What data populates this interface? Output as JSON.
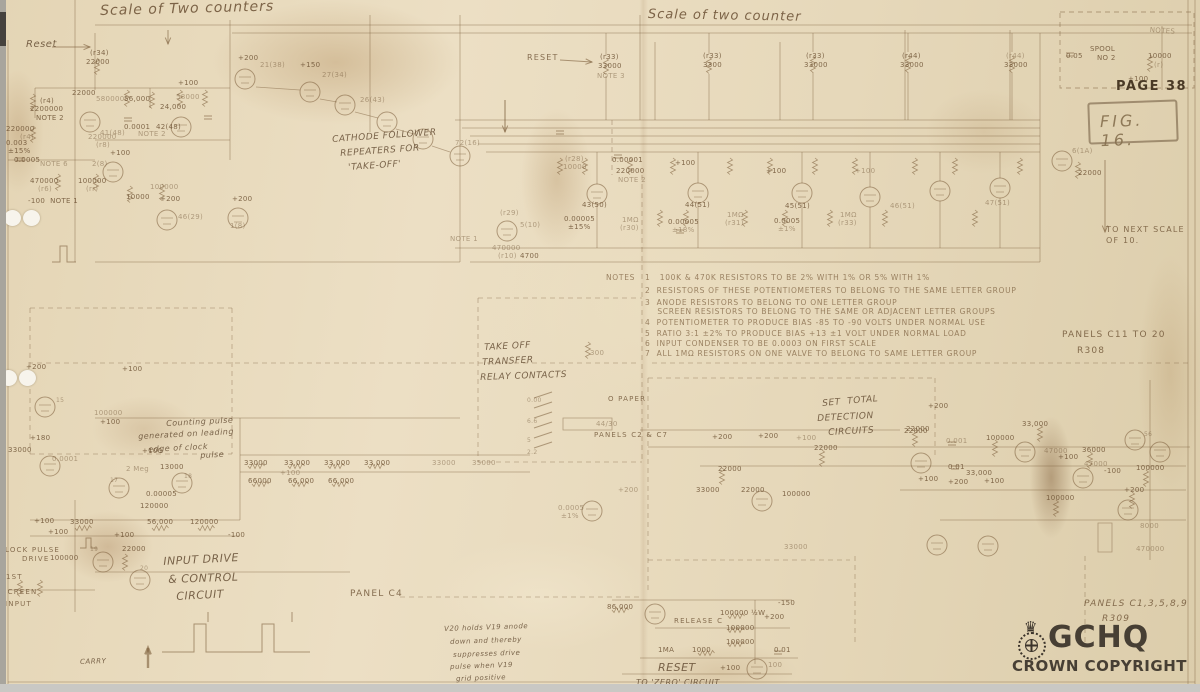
{
  "page": {
    "page_label": "PAGE 38",
    "figure_label": "FIG. 16.",
    "r308_panels": "PANELS C11 TO 20",
    "r308_ref": "R308",
    "r309_panels": "PANELS C1,3,5,8,9",
    "r309_ref": "R309",
    "next_scale_line1": "TO NEXT SCALE",
    "next_scale_line2": "OF 10.",
    "watermark_brand": "GCHQ",
    "watermark_sub": "CROWN COPYRIGHT",
    "watermark_crown_icon": "crown-icon"
  },
  "titles": {
    "left": "Scale of Two counters",
    "middle": "Scale of two counter"
  },
  "notes": {
    "heading": "NOTES",
    "items": [
      "1   100K & 470K RESISTORS TO BE 2% WITH 1% OR 5% WITH 1%",
      "2  RESISTORS OF THESE POTENTIOMETERS TO BELONG TO THE SAME LETTER GROUP",
      "3  ANODE RESISTORS TO BELONG TO ONE LETTER GROUP",
      "    SCREEN RESISTORS TO BELONG TO THE SAME OR ADJACENT LETTER GROUPS",
      "4  POTENTIOMETER TO PRODUCE BIAS -85 TO -90 VOLTS UNDER NORMAL USE",
      "5  RATIO 3:1 ±2% TO PRODUCE BIAS +13 ±1 VOLT UNDER NORMAL LOAD",
      "6  INPUT CONDENSER TO BE 0.0003 ON FIRST SCALE",
      "7  ALL 1MΩ RESISTORS ON ONE VALVE TO BELONG TO SAME LETTER GROUP"
    ]
  },
  "labels": [
    {
      "t": "Reset",
      "x": 26,
      "y": 40,
      "c": "h",
      "s": 10,
      "n": "reset-left-label"
    },
    {
      "t": "(r34)",
      "x": 90,
      "y": 50
    },
    {
      "t": "22000",
      "x": 86,
      "y": 59
    },
    {
      "t": "+200",
      "x": 238,
      "y": 55
    },
    {
      "t": "21(38)",
      "x": 260,
      "y": 62,
      "c": "vf"
    },
    {
      "t": "+150",
      "x": 300,
      "y": 62
    },
    {
      "t": "27(34)",
      "x": 322,
      "y": 72,
      "c": "vf"
    },
    {
      "t": "26(43)",
      "x": 360,
      "y": 97,
      "c": "vf"
    },
    {
      "t": "72(16)",
      "x": 455,
      "y": 140,
      "c": "vf"
    },
    {
      "t": "+100",
      "x": 178,
      "y": 80
    },
    {
      "t": "22000",
      "x": 72,
      "y": 90
    },
    {
      "t": "580000",
      "x": 96,
      "y": 96,
      "c": "vf"
    },
    {
      "t": "56,000",
      "x": 124,
      "y": 96
    },
    {
      "t": "24,000",
      "x": 160,
      "y": 104
    },
    {
      "t": "58000",
      "x": 176,
      "y": 94,
      "c": "vf"
    },
    {
      "t": "(r4)",
      "x": 40,
      "y": 98
    },
    {
      "t": "2200000",
      "x": 30,
      "y": 106
    },
    {
      "t": "NOTE 2",
      "x": 36,
      "y": 115
    },
    {
      "t": "220000",
      "x": 6,
      "y": 126
    },
    {
      "t": "(r4)",
      "x": 20,
      "y": 134,
      "c": "vf"
    },
    {
      "t": "0.003",
      "x": 6,
      "y": 140
    },
    {
      "t": "±15%",
      "x": 8,
      "y": 148
    },
    {
      "t": "0.0005",
      "x": 14,
      "y": 157
    },
    {
      "t": "NOTE 6",
      "x": 40,
      "y": 161,
      "c": "vf"
    },
    {
      "t": "41(48)",
      "x": 100,
      "y": 130,
      "c": "vf"
    },
    {
      "t": "220000",
      "x": 88,
      "y": 134,
      "c": "vf"
    },
    {
      "t": "(r8)",
      "x": 96,
      "y": 142,
      "c": "vf"
    },
    {
      "t": "0.0001",
      "x": 124,
      "y": 124
    },
    {
      "t": "NOTE 2",
      "x": 138,
      "y": 131,
      "c": "vf"
    },
    {
      "t": "42(48)",
      "x": 156,
      "y": 124
    },
    {
      "t": "470000",
      "x": 30,
      "y": 178
    },
    {
      "t": "(r6)",
      "x": 38,
      "y": 186,
      "c": "vf"
    },
    {
      "t": "100000",
      "x": 78,
      "y": 178
    },
    {
      "t": "(rr)",
      "x": 86,
      "y": 186,
      "c": "vf"
    },
    {
      "t": "-100  NOTE 1",
      "x": 28,
      "y": 198
    },
    {
      "t": "2(8)",
      "x": 92,
      "y": 161,
      "c": "vf"
    },
    {
      "t": "+100",
      "x": 110,
      "y": 150
    },
    {
      "t": "100000",
      "x": 150,
      "y": 184,
      "c": "vf"
    },
    {
      "t": "10000",
      "x": 126,
      "y": 194
    },
    {
      "t": "+200",
      "x": 160,
      "y": 196
    },
    {
      "t": "46(29)",
      "x": 178,
      "y": 214,
      "c": "vf"
    },
    {
      "t": "+200",
      "x": 232,
      "y": 196
    },
    {
      "t": "1(8)",
      "x": 230,
      "y": 223,
      "c": "vf"
    },
    {
      "t": "CATHODE FOLLOWER",
      "x": 332,
      "y": 136,
      "c": "h",
      "r": -4,
      "n": "section-cathode-followers"
    },
    {
      "t": "REPEATERS FOR",
      "x": 340,
      "y": 150,
      "c": "h",
      "r": -4
    },
    {
      "t": "'TAKE-OFF'",
      "x": 348,
      "y": 164,
      "c": "h",
      "r": -4
    },
    {
      "t": "RESET",
      "x": 527,
      "y": 54,
      "c": "d",
      "n": "reset-mid-label"
    },
    {
      "t": "(r33)",
      "x": 600,
      "y": 54
    },
    {
      "t": "33000",
      "x": 598,
      "y": 63
    },
    {
      "t": "NOTE 3",
      "x": 597,
      "y": 73,
      "c": "vf"
    },
    {
      "t": "(r33)",
      "x": 703,
      "y": 53
    },
    {
      "t": "3300",
      "x": 703,
      "y": 62
    },
    {
      "t": "(r33)",
      "x": 806,
      "y": 53
    },
    {
      "t": "33000",
      "x": 804,
      "y": 62
    },
    {
      "t": "(r44)",
      "x": 902,
      "y": 53
    },
    {
      "t": "33000",
      "x": 900,
      "y": 62
    },
    {
      "t": "(r44)",
      "x": 1006,
      "y": 53,
      "c": "vf"
    },
    {
      "t": "33000",
      "x": 1004,
      "y": 62
    },
    {
      "t": "NOTES",
      "x": 1150,
      "y": 27,
      "c": "vf",
      "r": 4
    },
    {
      "t": "SPOOL",
      "x": 1090,
      "y": 46
    },
    {
      "t": "NO 2",
      "x": 1097,
      "y": 55
    },
    {
      "t": "0.05",
      "x": 1066,
      "y": 53
    },
    {
      "t": "10000",
      "x": 1148,
      "y": 53
    },
    {
      "t": "(r)",
      "x": 1154,
      "y": 62,
      "c": "vf"
    },
    {
      "t": "+100",
      "x": 1128,
      "y": 76
    },
    {
      "t": "6(1A)",
      "x": 1072,
      "y": 148,
      "c": "vf"
    },
    {
      "t": "22000",
      "x": 1078,
      "y": 170
    },
    {
      "t": "(r28)",
      "x": 565,
      "y": 156,
      "c": "vf"
    },
    {
      "t": "10000",
      "x": 563,
      "y": 164,
      "c": "vf"
    },
    {
      "t": "0.00001",
      "x": 612,
      "y": 157
    },
    {
      "t": "220000",
      "x": 616,
      "y": 168
    },
    {
      "t": "NOTE 2",
      "x": 618,
      "y": 177,
      "c": "vf"
    },
    {
      "t": "43(50)",
      "x": 582,
      "y": 202
    },
    {
      "t": "0.00005",
      "x": 564,
      "y": 216
    },
    {
      "t": "±15%",
      "x": 568,
      "y": 224
    },
    {
      "t": "1MΩ",
      "x": 622,
      "y": 217,
      "c": "vf"
    },
    {
      "t": "(r30)",
      "x": 620,
      "y": 225,
      "c": "vf"
    },
    {
      "t": "+100",
      "x": 675,
      "y": 160
    },
    {
      "t": "44(51)",
      "x": 685,
      "y": 202
    },
    {
      "t": "0.00005",
      "x": 668,
      "y": 219
    },
    {
      "t": "±18%",
      "x": 672,
      "y": 227,
      "c": "vf"
    },
    {
      "t": "1MΩ",
      "x": 727,
      "y": 212,
      "c": "vf"
    },
    {
      "t": "(r31)",
      "x": 725,
      "y": 220,
      "c": "vf"
    },
    {
      "t": "+100",
      "x": 766,
      "y": 168
    },
    {
      "t": "45(51)",
      "x": 785,
      "y": 203
    },
    {
      "t": "0.0005",
      "x": 774,
      "y": 218
    },
    {
      "t": "±1%",
      "x": 778,
      "y": 226,
      "c": "vf"
    },
    {
      "t": "1MΩ",
      "x": 840,
      "y": 212,
      "c": "vf"
    },
    {
      "t": "(r33)",
      "x": 838,
      "y": 220,
      "c": "vf"
    },
    {
      "t": "46(51)",
      "x": 890,
      "y": 203,
      "c": "vf"
    },
    {
      "t": "+100",
      "x": 855,
      "y": 168,
      "c": "vf"
    },
    {
      "t": "47(51)",
      "x": 985,
      "y": 200,
      "c": "vf"
    },
    {
      "t": "NOTE 1",
      "x": 450,
      "y": 236,
      "c": "vf"
    },
    {
      "t": "(r29)",
      "x": 500,
      "y": 210,
      "c": "vf"
    },
    {
      "t": "5(10)",
      "x": 520,
      "y": 222,
      "c": "vf"
    },
    {
      "t": "470000",
      "x": 492,
      "y": 245,
      "c": "vf"
    },
    {
      "t": "(r10)",
      "x": 498,
      "y": 253,
      "c": "vf"
    },
    {
      "t": "4700",
      "x": 520,
      "y": 253
    },
    {
      "t": "TAKE OFF",
      "x": 484,
      "y": 344,
      "c": "h",
      "r": -3,
      "n": "section-take-off"
    },
    {
      "t": "TRANSFER",
      "x": 482,
      "y": 359,
      "c": "h",
      "r": -3
    },
    {
      "t": "RELAY CONTACTS",
      "x": 480,
      "y": 374,
      "c": "h",
      "r": -2
    },
    {
      "t": "300",
      "x": 590,
      "y": 350,
      "c": "vf"
    },
    {
      "t": "0.00",
      "x": 527,
      "y": 398,
      "c": "vf",
      "s": 6
    },
    {
      "t": "6.6",
      "x": 527,
      "y": 419,
      "c": "vf",
      "s": 6
    },
    {
      "t": "5",
      "x": 527,
      "y": 438,
      "c": "vf",
      "s": 6
    },
    {
      "t": "2.2",
      "x": 527,
      "y": 450,
      "c": "vf",
      "s": 6
    },
    {
      "t": "O PAPER",
      "x": 608,
      "y": 396,
      "c": "d",
      "s": 7
    },
    {
      "t": "44/30",
      "x": 596,
      "y": 421,
      "c": "vf"
    },
    {
      "t": "PANELS C2 & C7",
      "x": 594,
      "y": 432,
      "c": "d",
      "s": 7,
      "n": "panels-c2-c7-label"
    },
    {
      "t": "SET  TOTAL",
      "x": 822,
      "y": 400,
      "c": "h",
      "r": -5,
      "n": "section-set-total"
    },
    {
      "t": "DETECTION",
      "x": 817,
      "y": 415,
      "c": "h",
      "r": -3
    },
    {
      "t": "CIRCUITS",
      "x": 828,
      "y": 429,
      "c": "h",
      "r": -3
    },
    {
      "t": "+200",
      "x": 928,
      "y": 403
    },
    {
      "t": "22000",
      "x": 906,
      "y": 426
    },
    {
      "t": "+100",
      "x": 796,
      "y": 435,
      "c": "vf"
    },
    {
      "t": "22000",
      "x": 814,
      "y": 445
    },
    {
      "t": "Counting pulse",
      "x": 166,
      "y": 420,
      "c": "h",
      "s": 8,
      "r": -3,
      "n": "counting-pulse-note"
    },
    {
      "t": "generated on leading",
      "x": 138,
      "y": 433,
      "c": "h",
      "s": 8,
      "r": -3
    },
    {
      "t": "edge of clock",
      "x": 148,
      "y": 446,
      "c": "h",
      "s": 8,
      "r": -3
    },
    {
      "t": "pulse",
      "x": 200,
      "y": 452,
      "c": "h",
      "s": 8,
      "r": -3
    },
    {
      "t": "+200",
      "x": 26,
      "y": 364
    },
    {
      "t": "+100",
      "x": 122,
      "y": 366
    },
    {
      "t": "15",
      "x": 56,
      "y": 398,
      "c": "vf",
      "s": 6
    },
    {
      "t": "100000",
      "x": 94,
      "y": 410,
      "c": "vf"
    },
    {
      "t": "+100",
      "x": 100,
      "y": 419
    },
    {
      "t": "+180",
      "x": 30,
      "y": 435
    },
    {
      "t": "33000",
      "x": 8,
      "y": 447
    },
    {
      "t": "0.0001",
      "x": 52,
      "y": 456,
      "c": "vf"
    },
    {
      "t": "2 Meg",
      "x": 126,
      "y": 466,
      "c": "vf"
    },
    {
      "t": "13000",
      "x": 160,
      "y": 464
    },
    {
      "t": "+100",
      "x": 142,
      "y": 448
    },
    {
      "t": "17",
      "x": 110,
      "y": 478,
      "c": "vf",
      "s": 6
    },
    {
      "t": "18",
      "x": 184,
      "y": 474,
      "c": "vf",
      "s": 6
    },
    {
      "t": "0.00005",
      "x": 146,
      "y": 491
    },
    {
      "t": "120000",
      "x": 140,
      "y": 503
    },
    {
      "t": "33000",
      "x": 244,
      "y": 460
    },
    {
      "t": "33,000",
      "x": 284,
      "y": 460
    },
    {
      "t": "33,000",
      "x": 324,
      "y": 460
    },
    {
      "t": "33,000",
      "x": 364,
      "y": 460
    },
    {
      "t": "+100",
      "x": 280,
      "y": 470,
      "c": "vf"
    },
    {
      "t": "66000",
      "x": 248,
      "y": 478
    },
    {
      "t": "66,000",
      "x": 288,
      "y": 478
    },
    {
      "t": "66,000",
      "x": 328,
      "y": 478
    },
    {
      "t": "33000",
      "x": 432,
      "y": 460,
      "c": "vf"
    },
    {
      "t": "35000",
      "x": 472,
      "y": 460,
      "c": "vf"
    },
    {
      "t": "+100",
      "x": 34,
      "y": 518
    },
    {
      "t": "33000",
      "x": 70,
      "y": 519
    },
    {
      "t": "56,000",
      "x": 147,
      "y": 519
    },
    {
      "t": "120000",
      "x": 190,
      "y": 519
    },
    {
      "t": "-100",
      "x": 228,
      "y": 532
    },
    {
      "t": "+100",
      "x": 48,
      "y": 529
    },
    {
      "t": "+100",
      "x": 114,
      "y": 532
    },
    {
      "t": "22000",
      "x": 122,
      "y": 546
    },
    {
      "t": "19",
      "x": 90,
      "y": 547,
      "c": "vf",
      "s": 6
    },
    {
      "t": "20",
      "x": 140,
      "y": 566,
      "c": "vf",
      "s": 6
    },
    {
      "t": "LOCK PULSE",
      "x": 5,
      "y": 547,
      "c": "d",
      "s": 7,
      "n": "lock-pulse-label"
    },
    {
      "t": "DRIVE",
      "x": 22,
      "y": 556,
      "c": "d",
      "s": 7
    },
    {
      "t": "100000",
      "x": 50,
      "y": 555
    },
    {
      "t": "1ST",
      "x": 6,
      "y": 574,
      "c": "d",
      "s": 7,
      "n": "screen-input-label"
    },
    {
      "t": "SCREEN",
      "x": 2,
      "y": 589,
      "c": "d",
      "s": 7
    },
    {
      "t": "INPUT",
      "x": 5,
      "y": 601,
      "c": "d",
      "s": 7
    },
    {
      "t": "INPUT DRIVE",
      "x": 163,
      "y": 556,
      "c": "h",
      "s": 11,
      "r": -3,
      "n": "section-input-drive"
    },
    {
      "t": "& CONTROL",
      "x": 168,
      "y": 574,
      "c": "h",
      "s": 11,
      "r": -2
    },
    {
      "t": "CIRCUIT",
      "x": 176,
      "y": 591,
      "c": "h",
      "s": 11,
      "r": -3
    },
    {
      "t": "PANEL C4",
      "x": 350,
      "y": 590,
      "c": "d",
      "s": 9,
      "n": "panel-c4-label"
    },
    {
      "t": "CARRY",
      "x": 80,
      "y": 659,
      "c": "h",
      "s": 7,
      "r": -2
    },
    {
      "t": "V20 holds V19 anode",
      "x": 444,
      "y": 626,
      "c": "h",
      "s": 7,
      "r": -2,
      "n": "v20-note"
    },
    {
      "t": "down and thereby",
      "x": 450,
      "y": 639,
      "c": "h",
      "s": 7,
      "r": -2
    },
    {
      "t": "suppresses drive",
      "x": 453,
      "y": 652,
      "c": "h",
      "s": 7,
      "r": -2
    },
    {
      "t": "pulse when V19",
      "x": 450,
      "y": 664,
      "c": "h",
      "s": 7,
      "r": -2
    },
    {
      "t": "grid positive",
      "x": 456,
      "y": 676,
      "c": "h",
      "s": 7,
      "r": -2
    },
    {
      "t": "86,000",
      "x": 607,
      "y": 604
    },
    {
      "t": "RELEASE C",
      "x": 674,
      "y": 618,
      "c": "d",
      "s": 7,
      "n": "release-c-label"
    },
    {
      "t": "100000 ½W",
      "x": 720,
      "y": 610
    },
    {
      "t": "+200",
      "x": 764,
      "y": 614
    },
    {
      "t": "-150",
      "x": 778,
      "y": 600
    },
    {
      "t": "100000",
      "x": 726,
      "y": 625
    },
    {
      "t": "100000",
      "x": 726,
      "y": 639
    },
    {
      "t": "1000",
      "x": 692,
      "y": 647
    },
    {
      "t": "1MA",
      "x": 658,
      "y": 647
    },
    {
      "t": "0.01",
      "x": 774,
      "y": 647
    },
    {
      "t": "+100",
      "x": 720,
      "y": 665
    },
    {
      "t": "100",
      "x": 768,
      "y": 662,
      "c": "vf"
    },
    {
      "t": "RESET",
      "x": 658,
      "y": 662,
      "c": "h",
      "s": 11,
      "n": "reset-zero-heading"
    },
    {
      "t": "TO 'ZERO' CIRCUIT",
      "x": 636,
      "y": 679,
      "c": "h",
      "s": 8
    },
    {
      "t": "0.0005",
      "x": 558,
      "y": 505,
      "c": "vf"
    },
    {
      "t": "±1%",
      "x": 561,
      "y": 513,
      "c": "vf"
    },
    {
      "t": "+200",
      "x": 618,
      "y": 487,
      "c": "vf"
    },
    {
      "t": "+200",
      "x": 712,
      "y": 434
    },
    {
      "t": "+200",
      "x": 758,
      "y": 433
    },
    {
      "t": "22000",
      "x": 718,
      "y": 466
    },
    {
      "t": "22000",
      "x": 741,
      "y": 487
    },
    {
      "t": "33000",
      "x": 696,
      "y": 487
    },
    {
      "t": "100000",
      "x": 782,
      "y": 491
    },
    {
      "t": "33000",
      "x": 784,
      "y": 544,
      "c": "vf"
    },
    {
      "t": "22000",
      "x": 904,
      "y": 428
    },
    {
      "t": "100000",
      "x": 986,
      "y": 435
    },
    {
      "t": "33,000",
      "x": 1022,
      "y": 421
    },
    {
      "t": "0.001",
      "x": 946,
      "y": 438,
      "c": "vf"
    },
    {
      "t": "47000",
      "x": 1044,
      "y": 448,
      "c": "vf"
    },
    {
      "t": "+100",
      "x": 1058,
      "y": 454
    },
    {
      "t": "36000",
      "x": 1082,
      "y": 447
    },
    {
      "t": "47000",
      "x": 1084,
      "y": 461,
      "c": "vf"
    },
    {
      "t": "-100",
      "x": 1104,
      "y": 468
    },
    {
      "t": "0.01",
      "x": 948,
      "y": 464
    },
    {
      "t": "33,000",
      "x": 966,
      "y": 470
    },
    {
      "t": "+100",
      "x": 918,
      "y": 476
    },
    {
      "t": "+200",
      "x": 948,
      "y": 479
    },
    {
      "t": "+100",
      "x": 984,
      "y": 478
    },
    {
      "t": "100000",
      "x": 1046,
      "y": 495
    },
    {
      "t": "+200",
      "x": 1124,
      "y": 487
    },
    {
      "t": "100000",
      "x": 1136,
      "y": 465
    },
    {
      "t": "8000",
      "x": 1140,
      "y": 523,
      "c": "vf"
    },
    {
      "t": "470000",
      "x": 1136,
      "y": 546,
      "c": "vf"
    },
    {
      "t": "56",
      "x": 1144,
      "y": 432,
      "c": "vf",
      "s": 6
    }
  ]
}
